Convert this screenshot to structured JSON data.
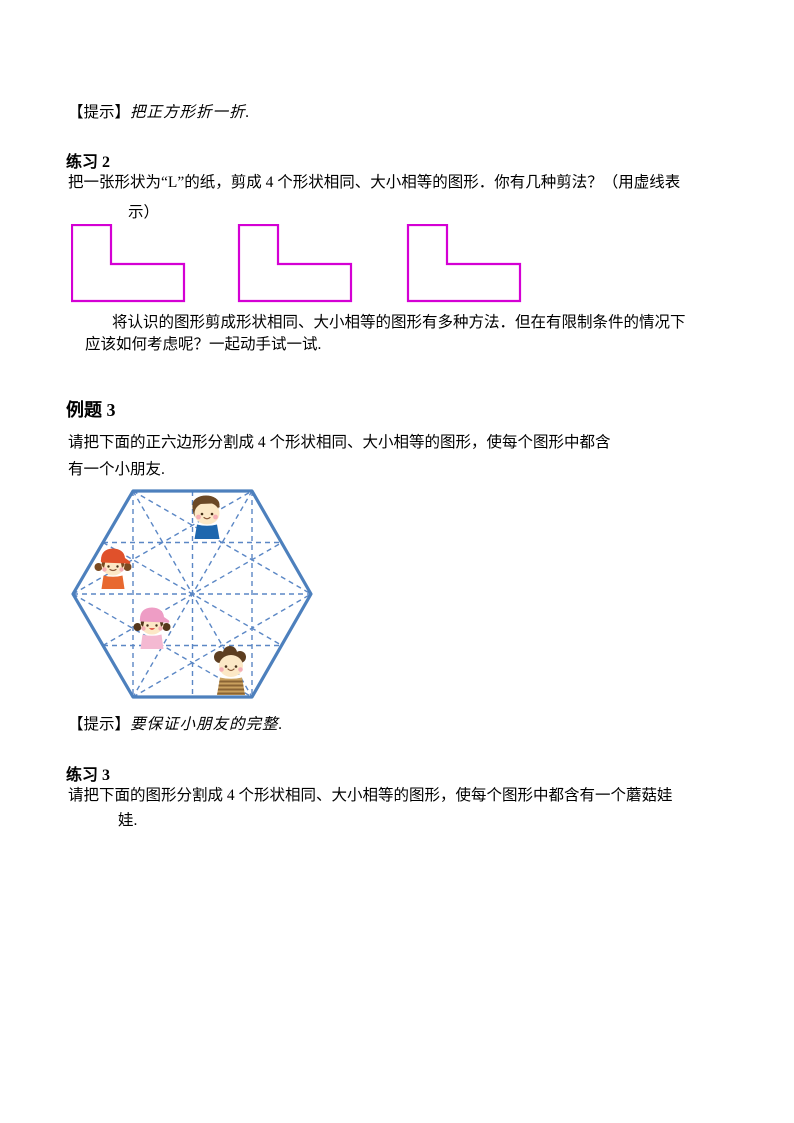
{
  "hint1": {
    "label": "【提示】",
    "text": "把正方形折一折."
  },
  "exercise2": {
    "heading": "练习 2",
    "line1": "把一张形状为“L”的纸，剪成 4 个形状相同、大小相等的图形．你有几种剪法？（用虚线表",
    "line2": "示）"
  },
  "l_shapes": {
    "description": "three identical L-shaped outlines",
    "count": 3,
    "stroke_color": "#d400d4"
  },
  "middle_paragraph": {
    "line1": "将认识的图形剪成形状相同、大小相等的图形有多种方法．但在有限制条件的情况下",
    "line2": "应该如何考虑呢？一起动手试一试."
  },
  "example3": {
    "heading": "例题 3",
    "line1": "请把下面的正六边形分割成 4 个形状相同、大小相等的图形，使每个图形中都含",
    "line2": "有一个小朋友."
  },
  "hexagon_figure": {
    "description": "regular hexagon with dashed triangular grid and four children",
    "outline_color": "#4d80bd",
    "dash_color": "#5b87c5",
    "children": [
      {
        "name": "boy-blue-shirt",
        "position": "top-center"
      },
      {
        "name": "girl-orange-cap",
        "position": "middle-left"
      },
      {
        "name": "girl-pink-cap",
        "position": "center-lower-left"
      },
      {
        "name": "boy-striped-shirt",
        "position": "bottom-right"
      }
    ]
  },
  "hint2": {
    "label": "【提示】",
    "text": "要保证小朋友的完整."
  },
  "exercise3": {
    "heading": "练习 3",
    "line1": "请把下面的图形分割成 4 个形状相同、大小相等的图形，使每个图形中都含有一个蘑菇娃",
    "line2": "娃."
  }
}
